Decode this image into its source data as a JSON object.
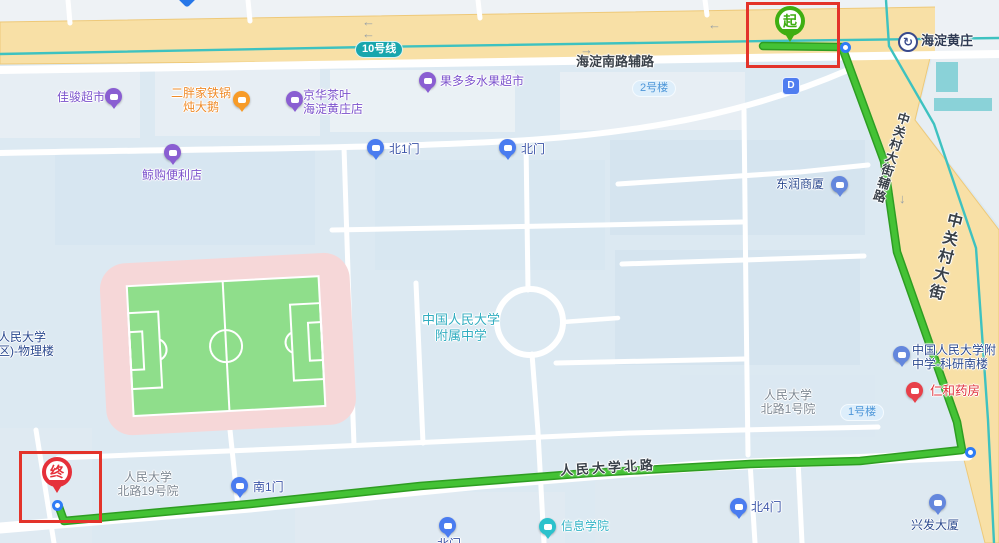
{
  "transit": {
    "line_badge": "10号线",
    "station": "海淀黄庄",
    "exit_label": "D"
  },
  "roads": {
    "haidian_south_aux": "海淀南路辅路",
    "zgc_aux": "中关村大街辅路",
    "zgc": "中关村大街",
    "rmdx_north": "人民大学北路"
  },
  "route": {
    "start": "起",
    "end": "终"
  },
  "pois": {
    "jiajun": {
      "name": "佳骏超市"
    },
    "erpang": {
      "line1": "二胖家铁锅",
      "line2": "炖大鹅"
    },
    "jinghua": {
      "line1": "京华茶叶",
      "line2": "海淀黄庄店"
    },
    "guoduoduo": {
      "name": "果多多水果超市"
    },
    "jinggou": {
      "name": "鲸购便利店"
    },
    "gate_n1": {
      "name": "北1门"
    },
    "gate_n": {
      "name": "北门"
    },
    "dongrun": {
      "name": "东润商厦"
    },
    "fuzhong": {
      "line1": "中国人民大学",
      "line2": "附属中学"
    },
    "keyan": {
      "line1": "中国人民大学附",
      "line2": "中学-科研南楼"
    },
    "renhe": {
      "name": "仁和药房"
    },
    "yard1": {
      "line1": "人民大学",
      "line2": "北路1号院"
    },
    "bldg1": {
      "name": "1号楼"
    },
    "bldg2": {
      "name": "2号楼"
    },
    "yard19": {
      "line1": "人民大学",
      "line2": "北路19号院"
    },
    "gate_s1": {
      "name": "南1门"
    },
    "xinxi": {
      "name": "信息学院"
    },
    "gate_n4": {
      "name": "北4门"
    },
    "xingfa": {
      "name": "兴发大厦"
    },
    "wuli": {
      "line1": "国人民大学",
      "line2": "校区)-物理楼"
    },
    "gate_bottom": {
      "name": "北门"
    }
  },
  "colors": {
    "route_green": "#44c235",
    "road_yellow": "#f8e0a6",
    "subway_teal": "#3ec2c0",
    "annotation_red": "#e3332a",
    "poi_purple": "#8a5ed2",
    "poi_orange": "#f79b28",
    "poi_gate_blue": "#4a7cf0",
    "poi_building_blue": "#6487dd",
    "poi_red": "#e8404a",
    "poi_teal": "#2cc2cc"
  }
}
